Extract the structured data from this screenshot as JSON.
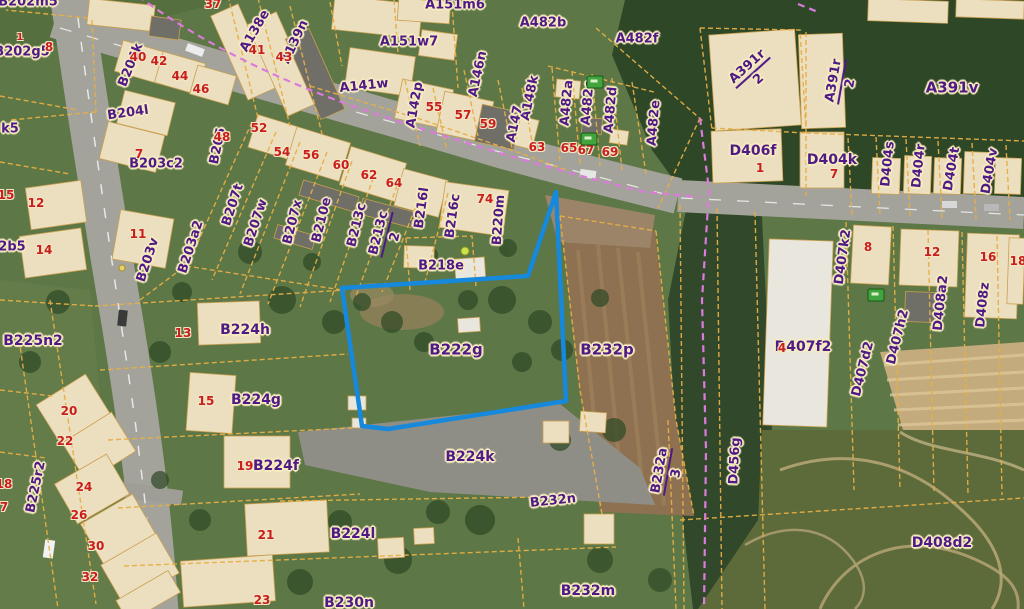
{
  "map": {
    "description": "aerial cadastral map view with parcel overlay",
    "selected_parcel": "B222g",
    "colors": {
      "parcel_label": "#4e1a86",
      "label_halo": "#f7ecc0",
      "house_number": "#c81e1e",
      "number_halo": "#f2e6c4",
      "cadastral_line": "#e7ae45",
      "boundary_magenta": "#db7bdb",
      "highlight_blue": "#1689dd"
    },
    "labels": [
      {
        "t": "B202m5",
        "x": 28,
        "y": 2,
        "r": 0,
        "k": "p"
      },
      {
        "t": "B202g5",
        "x": 22,
        "y": 52,
        "r": 0,
        "k": "p"
      },
      {
        "t": "B204k",
        "x": 131,
        "y": 65,
        "r": -68,
        "k": "p"
      },
      {
        "t": "B204l",
        "x": 128,
        "y": 113,
        "r": -8,
        "k": "p"
      },
      {
        "t": "B203c2",
        "x": 156,
        "y": 164,
        "r": 0,
        "k": "p"
      },
      {
        "t": "B205",
        "x": 218,
        "y": 146,
        "r": -78,
        "k": "p"
      },
      {
        "t": "B203v",
        "x": 148,
        "y": 260,
        "r": -72,
        "k": "p"
      },
      {
        "t": "B203a2",
        "x": 191,
        "y": 247,
        "r": -72,
        "k": "p"
      },
      {
        "t": "B207t",
        "x": 233,
        "y": 205,
        "r": -72,
        "k": "p"
      },
      {
        "t": "B207w",
        "x": 256,
        "y": 223,
        "r": -72,
        "k": "p"
      },
      {
        "t": "B207x",
        "x": 293,
        "y": 222,
        "r": -76,
        "k": "p"
      },
      {
        "t": "B210e",
        "x": 322,
        "y": 220,
        "r": -76,
        "k": "p"
      },
      {
        "t": "B213c",
        "x": 357,
        "y": 225,
        "r": -76,
        "k": "p"
      },
      {
        "t": "B213c",
        "x": 387,
        "y": 235,
        "r": -76,
        "k": "p",
        "d": "2"
      },
      {
        "t": "B216l",
        "x": 422,
        "y": 208,
        "r": -82,
        "k": "p"
      },
      {
        "t": "B216c",
        "x": 453,
        "y": 216,
        "r": -82,
        "k": "p"
      },
      {
        "t": "B220m",
        "x": 499,
        "y": 220,
        "r": -86,
        "k": "p"
      },
      {
        "t": "B218e",
        "x": 441,
        "y": 266,
        "r": 0,
        "k": "p"
      },
      {
        "t": "B222g",
        "x": 456,
        "y": 350,
        "r": 0,
        "k": "p",
        "s": 15
      },
      {
        "t": "B232p",
        "x": 607,
        "y": 350,
        "r": 0,
        "k": "p",
        "s": 15
      },
      {
        "t": "B224h",
        "x": 245,
        "y": 330,
        "r": 0,
        "k": "p",
        "s": 14
      },
      {
        "t": "B224g",
        "x": 256,
        "y": 400,
        "r": 0,
        "k": "p",
        "s": 14
      },
      {
        "t": "B224f",
        "x": 276,
        "y": 466,
        "r": 0,
        "k": "p",
        "s": 14
      },
      {
        "t": "B225n2",
        "x": 33,
        "y": 341,
        "r": 0,
        "k": "p",
        "s": 14
      },
      {
        "t": "B225r2",
        "x": 36,
        "y": 487,
        "r": -78,
        "k": "p"
      },
      {
        "t": "B224k",
        "x": 470,
        "y": 457,
        "r": 0,
        "k": "p",
        "s": 14
      },
      {
        "t": "B224l",
        "x": 353,
        "y": 534,
        "r": 0,
        "k": "p",
        "s": 14
      },
      {
        "t": "B230n",
        "x": 349,
        "y": 603,
        "r": 0,
        "k": "p",
        "s": 14
      },
      {
        "t": "B232n",
        "x": 553,
        "y": 501,
        "r": -6,
        "k": "p"
      },
      {
        "t": "B232m",
        "x": 588,
        "y": 591,
        "r": 0,
        "k": "p",
        "s": 14
      },
      {
        "t": "B232a",
        "x": 668,
        "y": 472,
        "r": -80,
        "k": "p",
        "d": "3"
      },
      {
        "t": "D456g",
        "x": 735,
        "y": 461,
        "r": -87,
        "k": "p"
      },
      {
        "t": "D406f",
        "x": 753,
        "y": 151,
        "r": 0,
        "k": "p",
        "s": 14
      },
      {
        "t": "D404k",
        "x": 832,
        "y": 160,
        "r": 0,
        "k": "p",
        "s": 14
      },
      {
        "t": "D404s",
        "x": 888,
        "y": 164,
        "r": -84,
        "k": "p"
      },
      {
        "t": "D404r",
        "x": 919,
        "y": 166,
        "r": -84,
        "k": "p"
      },
      {
        "t": "D404t",
        "x": 952,
        "y": 169,
        "r": -80,
        "k": "p"
      },
      {
        "t": "D404v",
        "x": 990,
        "y": 171,
        "r": -80,
        "k": "p"
      },
      {
        "t": "A391v",
        "x": 952,
        "y": 88,
        "r": 0,
        "k": "p",
        "s": 15
      },
      {
        "t": "A391r",
        "x": 753,
        "y": 73,
        "r": -42,
        "k": "p",
        "d": "2"
      },
      {
        "t": "A391r",
        "x": 842,
        "y": 82,
        "r": -80,
        "k": "p",
        "d": "2"
      },
      {
        "t": "D407k2",
        "x": 843,
        "y": 257,
        "r": -82,
        "k": "p"
      },
      {
        "t": "D407f2",
        "x": 803,
        "y": 347,
        "r": 0,
        "k": "p",
        "s": 14
      },
      {
        "t": "D408a2",
        "x": 941,
        "y": 303,
        "r": -84,
        "k": "p"
      },
      {
        "t": "D408z",
        "x": 983,
        "y": 305,
        "r": -84,
        "k": "p"
      },
      {
        "t": "D407h2",
        "x": 898,
        "y": 337,
        "r": -76,
        "k": "p"
      },
      {
        "t": "D407d2",
        "x": 863,
        "y": 369,
        "r": -76,
        "k": "p"
      },
      {
        "t": "D408d2",
        "x": 942,
        "y": 543,
        "r": 0,
        "k": "p",
        "s": 14
      },
      {
        "t": "A151m6",
        "x": 455,
        "y": 5,
        "r": 0,
        "k": "p"
      },
      {
        "t": "A151w7",
        "x": 409,
        "y": 42,
        "r": 0,
        "k": "p"
      },
      {
        "t": "A482b",
        "x": 543,
        "y": 23,
        "r": 0,
        "k": "p"
      },
      {
        "t": "A482f",
        "x": 637,
        "y": 39,
        "r": 0,
        "k": "p"
      },
      {
        "t": "A141w",
        "x": 364,
        "y": 86,
        "r": -6,
        "k": "p"
      },
      {
        "t": "A142p",
        "x": 415,
        "y": 105,
        "r": -80,
        "k": "p"
      },
      {
        "t": "A146n",
        "x": 478,
        "y": 74,
        "r": -78,
        "k": "p"
      },
      {
        "t": "A148k",
        "x": 530,
        "y": 98,
        "r": -78,
        "k": "p"
      },
      {
        "t": "A147",
        "x": 515,
        "y": 124,
        "r": -78,
        "k": "p"
      },
      {
        "t": "A482a",
        "x": 567,
        "y": 103,
        "r": -85,
        "k": "p"
      },
      {
        "t": "A482c",
        "x": 588,
        "y": 103,
        "r": -85,
        "k": "p"
      },
      {
        "t": "A482d",
        "x": 611,
        "y": 110,
        "r": -85,
        "k": "p"
      },
      {
        "t": "A482e",
        "x": 654,
        "y": 123,
        "r": -85,
        "k": "p"
      },
      {
        "t": "A138e",
        "x": 255,
        "y": 31,
        "r": -60,
        "k": "p"
      },
      {
        "t": "A139n",
        "x": 295,
        "y": 42,
        "r": -65,
        "k": "p"
      },
      {
        "t": "k5",
        "x": 10,
        "y": 129,
        "r": 0,
        "k": "p"
      },
      {
        "t": "2b5",
        "x": 12,
        "y": 247,
        "r": 0,
        "k": "p"
      },
      {
        "t": "1",
        "x": 20,
        "y": 38,
        "r": 0,
        "k": "n",
        "s": 10
      },
      {
        "t": "8",
        "x": 49,
        "y": 47,
        "r": 0,
        "k": "n"
      },
      {
        "t": "37",
        "x": 213,
        "y": 4,
        "r": 0,
        "k": "n"
      },
      {
        "t": "40",
        "x": 138,
        "y": 57,
        "r": 0,
        "k": "n"
      },
      {
        "t": "41",
        "x": 257,
        "y": 50,
        "r": 0,
        "k": "n"
      },
      {
        "t": "42",
        "x": 159,
        "y": 61,
        "r": 0,
        "k": "n"
      },
      {
        "t": "43",
        "x": 284,
        "y": 57,
        "r": 0,
        "k": "n"
      },
      {
        "t": "44",
        "x": 180,
        "y": 76,
        "r": 0,
        "k": "n"
      },
      {
        "t": "46",
        "x": 201,
        "y": 89,
        "r": 0,
        "k": "n"
      },
      {
        "t": "48",
        "x": 222,
        "y": 137,
        "r": 0,
        "k": "n"
      },
      {
        "t": "52",
        "x": 259,
        "y": 128,
        "r": 0,
        "k": "n"
      },
      {
        "t": "54",
        "x": 282,
        "y": 152,
        "r": 0,
        "k": "n"
      },
      {
        "t": "55",
        "x": 434,
        "y": 107,
        "r": 0,
        "k": "n"
      },
      {
        "t": "56",
        "x": 311,
        "y": 155,
        "r": 0,
        "k": "n"
      },
      {
        "t": "57",
        "x": 463,
        "y": 115,
        "r": 0,
        "k": "n"
      },
      {
        "t": "59",
        "x": 488,
        "y": 124,
        "r": 0,
        "k": "n"
      },
      {
        "t": "60",
        "x": 341,
        "y": 165,
        "r": 0,
        "k": "n"
      },
      {
        "t": "62",
        "x": 369,
        "y": 175,
        "r": 0,
        "k": "n"
      },
      {
        "t": "63",
        "x": 537,
        "y": 147,
        "r": 0,
        "k": "n"
      },
      {
        "t": "64",
        "x": 394,
        "y": 183,
        "r": 0,
        "k": "n"
      },
      {
        "t": "65",
        "x": 569,
        "y": 148,
        "r": 0,
        "k": "n"
      },
      {
        "t": "67",
        "x": 586,
        "y": 150,
        "r": 0,
        "k": "n"
      },
      {
        "t": "69",
        "x": 610,
        "y": 152,
        "r": 0,
        "k": "n"
      },
      {
        "t": "74",
        "x": 485,
        "y": 199,
        "r": 0,
        "k": "n"
      },
      {
        "t": "7",
        "x": 139,
        "y": 154,
        "r": 0,
        "k": "n"
      },
      {
        "t": "11",
        "x": 138,
        "y": 234,
        "r": 0,
        "k": "n"
      },
      {
        "t": "12",
        "x": 36,
        "y": 203,
        "r": 0,
        "k": "n"
      },
      {
        "t": "13",
        "x": 183,
        "y": 333,
        "r": 0,
        "k": "n"
      },
      {
        "t": "14",
        "x": 44,
        "y": 250,
        "r": 0,
        "k": "n"
      },
      {
        "t": "15",
        "x": 6,
        "y": 195,
        "r": 0,
        "k": "n"
      },
      {
        "t": "15",
        "x": 206,
        "y": 401,
        "r": 0,
        "k": "n"
      },
      {
        "t": "19",
        "x": 245,
        "y": 466,
        "r": 0,
        "k": "n"
      },
      {
        "t": "20",
        "x": 69,
        "y": 411,
        "r": 0,
        "k": "n"
      },
      {
        "t": "21",
        "x": 266,
        "y": 535,
        "r": 0,
        "k": "n"
      },
      {
        "t": "22",
        "x": 65,
        "y": 441,
        "r": 0,
        "k": "n"
      },
      {
        "t": "23",
        "x": 262,
        "y": 600,
        "r": 0,
        "k": "n"
      },
      {
        "t": "24",
        "x": 84,
        "y": 487,
        "r": 0,
        "k": "n"
      },
      {
        "t": "26",
        "x": 79,
        "y": 515,
        "r": 0,
        "k": "n"
      },
      {
        "t": "30",
        "x": 96,
        "y": 546,
        "r": 0,
        "k": "n"
      },
      {
        "t": "32",
        "x": 90,
        "y": 577,
        "r": 0,
        "k": "n"
      },
      {
        "t": "18",
        "x": 4,
        "y": 484,
        "r": 0,
        "k": "n"
      },
      {
        "t": "7",
        "x": 4,
        "y": 507,
        "r": 0,
        "k": "n"
      },
      {
        "t": "1",
        "x": 760,
        "y": 168,
        "r": 0,
        "k": "n"
      },
      {
        "t": "7",
        "x": 834,
        "y": 174,
        "r": 0,
        "k": "n"
      },
      {
        "t": "8",
        "x": 868,
        "y": 247,
        "r": 0,
        "k": "n"
      },
      {
        "t": "12",
        "x": 932,
        "y": 252,
        "r": 0,
        "k": "n"
      },
      {
        "t": "16",
        "x": 988,
        "y": 257,
        "r": 0,
        "k": "n"
      },
      {
        "t": "18",
        "x": 1018,
        "y": 261,
        "r": 0,
        "k": "n"
      },
      {
        "t": "4",
        "x": 782,
        "y": 348,
        "r": 0,
        "k": "n"
      }
    ],
    "icons": [
      {
        "name": "green-hut-icon",
        "x": 595,
        "y": 82
      },
      {
        "name": "green-hut-icon",
        "x": 589,
        "y": 139
      },
      {
        "name": "green-hut-icon",
        "x": 876,
        "y": 295
      }
    ]
  }
}
